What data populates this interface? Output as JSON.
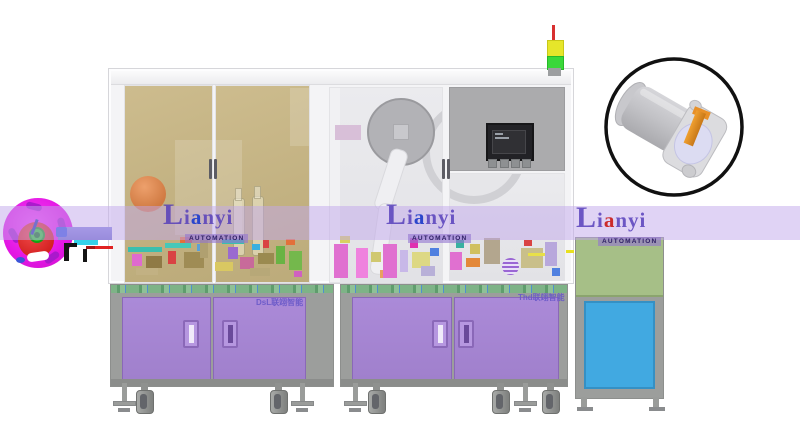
{
  "watermark": {
    "brand_cap": "L",
    "brand_mid": "i",
    "brand_accent": "a",
    "brand_rest": "nyi",
    "subtitle": "AUTOMATION",
    "instances": [
      {
        "left": 163,
        "top": 205,
        "accent": "blue"
      },
      {
        "left": 386,
        "top": 205,
        "accent": "blue"
      },
      {
        "left": 576,
        "top": 208,
        "accent": "red"
      }
    ]
  },
  "labels": {
    "left_cabinet": "DsL联翊智能",
    "right_cabinet": "Thd联翊智能"
  },
  "colors": {
    "reel_magenta": "#ee1fee",
    "reel_red": "#d42222",
    "reel_hub_green": "#2ecc2e",
    "band_lavender": "#c1a7eb",
    "logo_purple": "#523ab9",
    "logo_accent_blue": "#2b46cc",
    "logo_accent_red": "#cc2b2b",
    "glass_khaki": "#c7b686",
    "glass_gray": "#e6e6ea",
    "panel_gray": "#ababad",
    "door_purple": "#a584d2",
    "cabinet_gray": "#9c9e9c",
    "table_green": "#7eb387",
    "machine_green": "#a6bf87",
    "machine_blue": "#41a9e1",
    "signal_red": "#d83030",
    "signal_yellow": "#e6e62a",
    "signal_green": "#3ad83a",
    "detail_pin_orange": "#e8941f"
  },
  "signal_tower": {
    "segments": [
      "red",
      "yellow",
      "green"
    ]
  },
  "decor": {
    "blocks": [
      {
        "x": 128,
        "y": 247,
        "w": 34,
        "h": 5,
        "c": "#3bbfae"
      },
      {
        "x": 132,
        "y": 254,
        "w": 10,
        "h": 12,
        "c": "#df6ace"
      },
      {
        "x": 146,
        "y": 256,
        "w": 16,
        "h": 12,
        "c": "#8f7a45"
      },
      {
        "x": 165,
        "y": 243,
        "w": 26,
        "h": 5,
        "c": "#45c8b8"
      },
      {
        "x": 168,
        "y": 251,
        "w": 8,
        "h": 13,
        "c": "#d94343"
      },
      {
        "x": 180,
        "y": 237,
        "w": 12,
        "h": 6,
        "c": "#e3703a"
      },
      {
        "x": 184,
        "y": 252,
        "w": 20,
        "h": 16,
        "c": "#9f8c55"
      },
      {
        "x": 197,
        "y": 244,
        "w": 7,
        "h": 7,
        "c": "#5aa0d8"
      },
      {
        "x": 200,
        "y": 240,
        "w": 8,
        "h": 18,
        "c": "#b0a070"
      },
      {
        "x": 215,
        "y": 262,
        "w": 18,
        "h": 9,
        "c": "#d9c862"
      },
      {
        "x": 222,
        "y": 239,
        "w": 22,
        "h": 5,
        "c": "#3bbfae"
      },
      {
        "x": 228,
        "y": 247,
        "w": 10,
        "h": 12,
        "c": "#9a6ad0"
      },
      {
        "x": 240,
        "y": 257,
        "w": 14,
        "h": 12,
        "c": "#c86a9a"
      },
      {
        "x": 252,
        "y": 244,
        "w": 8,
        "h": 6,
        "c": "#38b0e0"
      },
      {
        "x": 258,
        "y": 253,
        "w": 16,
        "h": 11,
        "c": "#9a8a50"
      },
      {
        "x": 263,
        "y": 240,
        "w": 6,
        "h": 8,
        "c": "#d94343"
      },
      {
        "x": 276,
        "y": 246,
        "w": 9,
        "h": 18,
        "c": "#69b344"
      },
      {
        "x": 286,
        "y": 239,
        "w": 9,
        "h": 6,
        "c": "#e3703a"
      },
      {
        "x": 289,
        "y": 251,
        "w": 13,
        "h": 19,
        "c": "#74b84c"
      },
      {
        "x": 294,
        "y": 271,
        "w": 8,
        "h": 6,
        "c": "#d060c0"
      },
      {
        "x": 136,
        "y": 268,
        "w": 22,
        "h": 7,
        "c": "#c2b183"
      },
      {
        "x": 250,
        "y": 268,
        "w": 20,
        "h": 8,
        "c": "#b7a878"
      },
      {
        "x": 334,
        "y": 244,
        "w": 14,
        "h": 34,
        "c": "#e070d0"
      },
      {
        "x": 340,
        "y": 236,
        "w": 10,
        "h": 7,
        "c": "#d8d060"
      },
      {
        "x": 356,
        "y": 248,
        "w": 12,
        "h": 30,
        "c": "#ef82de"
      },
      {
        "x": 371,
        "y": 252,
        "w": 10,
        "h": 10,
        "c": "#d0c870"
      },
      {
        "x": 383,
        "y": 244,
        "w": 14,
        "h": 34,
        "c": "#e070d0"
      },
      {
        "x": 400,
        "y": 250,
        "w": 8,
        "h": 22,
        "c": "#c8b8e8"
      },
      {
        "x": 410,
        "y": 238,
        "w": 8,
        "h": 10,
        "c": "#e030b0"
      },
      {
        "x": 412,
        "y": 252,
        "w": 18,
        "h": 16,
        "c": "#ddd884"
      },
      {
        "x": 430,
        "y": 248,
        "w": 9,
        "h": 8,
        "c": "#5080e0"
      },
      {
        "x": 421,
        "y": 266,
        "w": 14,
        "h": 10,
        "c": "#b8b0d8"
      },
      {
        "x": 450,
        "y": 252,
        "w": 12,
        "h": 18,
        "c": "#e070d0"
      },
      {
        "x": 456,
        "y": 240,
        "w": 8,
        "h": 8,
        "c": "#38b0a0"
      },
      {
        "x": 466,
        "y": 258,
        "w": 14,
        "h": 9,
        "c": "#e3883a"
      },
      {
        "x": 470,
        "y": 244,
        "w": 10,
        "h": 10,
        "c": "#d0c060"
      },
      {
        "x": 484,
        "y": 238,
        "w": 16,
        "h": 26,
        "c": "#b3a68e"
      },
      {
        "x": 502,
        "y": 258,
        "w": 17,
        "h": 17,
        "c": "#9a66d4",
        "r": true,
        "s": true
      },
      {
        "x": 521,
        "y": 248,
        "w": 22,
        "h": 20,
        "c": "#c9bf8a"
      },
      {
        "x": 524,
        "y": 240,
        "w": 8,
        "h": 6,
        "c": "#d94343"
      },
      {
        "x": 528,
        "y": 253,
        "w": 26,
        "h": 3,
        "c": "#e8e048"
      },
      {
        "x": 545,
        "y": 242,
        "w": 12,
        "h": 24,
        "c": "#b8a8dc"
      },
      {
        "x": 552,
        "y": 268,
        "w": 8,
        "h": 8,
        "c": "#5080e0"
      },
      {
        "x": 566,
        "y": 250,
        "w": 8,
        "h": 3,
        "c": "#e8e020"
      }
    ],
    "legs": [
      {
        "x": 113,
        "type": "foot"
      },
      {
        "x": 134,
        "type": "caster"
      },
      {
        "x": 268,
        "type": "caster"
      },
      {
        "x": 291,
        "type": "foot"
      },
      {
        "x": 344,
        "type": "foot"
      },
      {
        "x": 366,
        "type": "caster"
      },
      {
        "x": 490,
        "type": "caster"
      },
      {
        "x": 514,
        "type": "foot"
      },
      {
        "x": 540,
        "type": "caster"
      },
      {
        "x": 577,
        "type": "machinefoot"
      },
      {
        "x": 649,
        "type": "machinefoot"
      }
    ]
  }
}
